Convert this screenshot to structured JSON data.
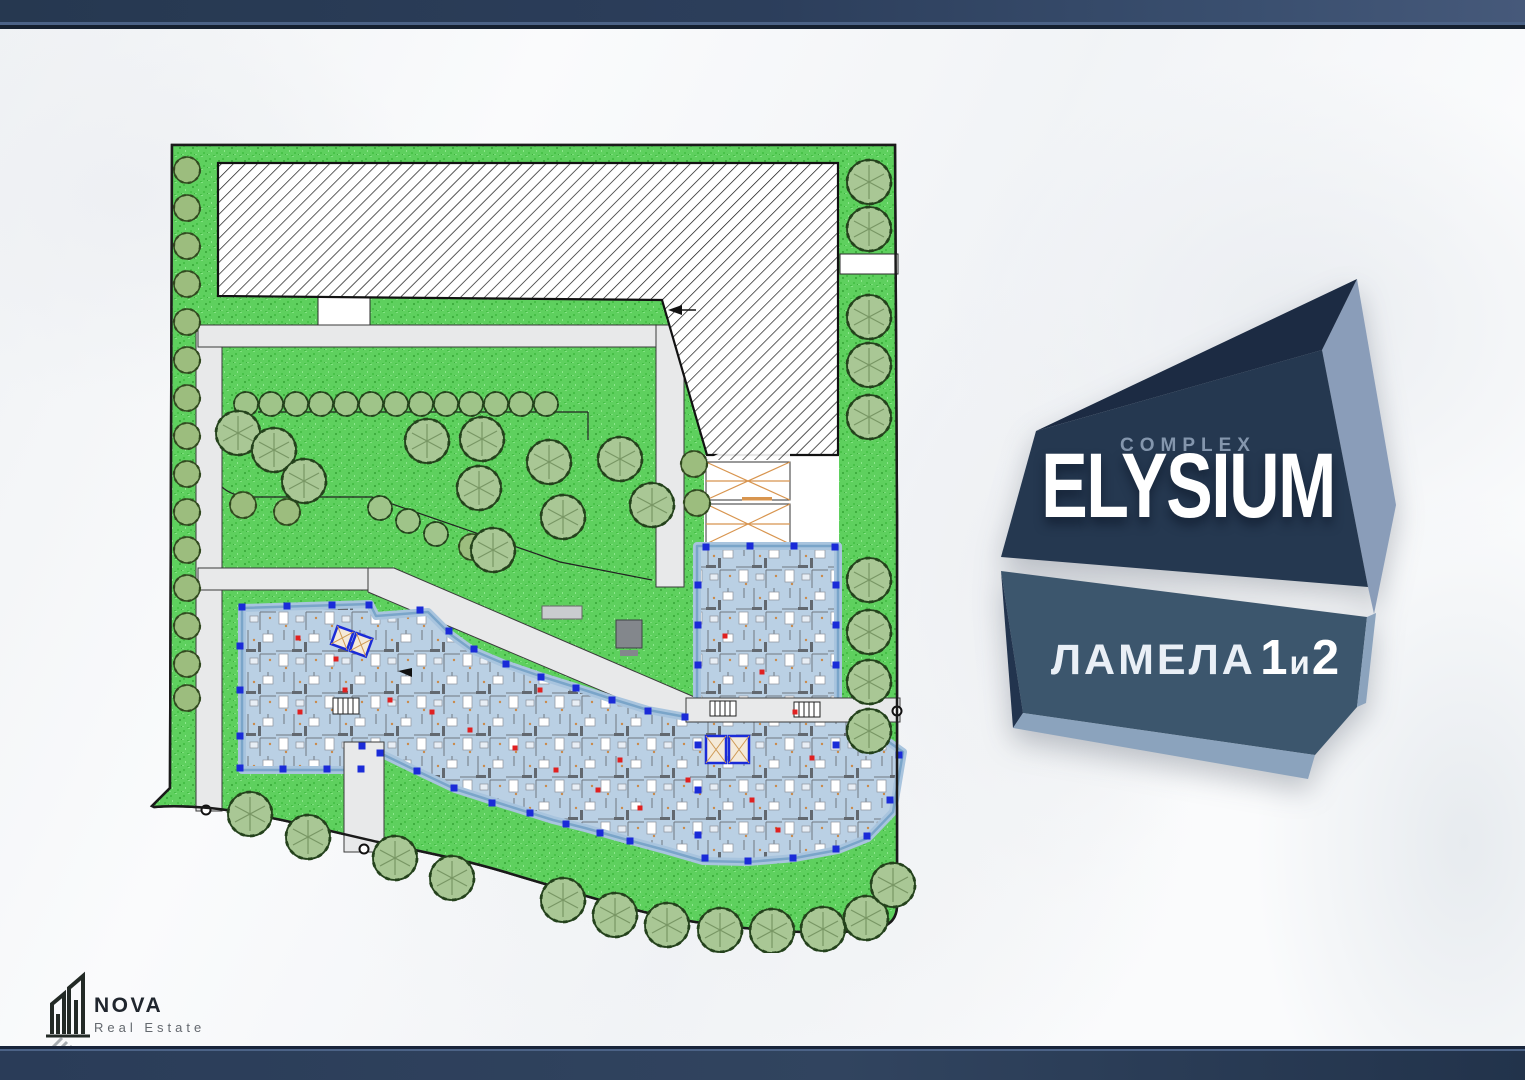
{
  "badge": {
    "kicker": "COMPLEX",
    "name": "ELYSIUM",
    "label": "ЛАМЕЛА",
    "unit_first": "1",
    "conjunction": "и",
    "unit_second": "2"
  },
  "logo": {
    "brand": "NOVA",
    "tagline": "Real Estate"
  },
  "colors": {
    "bar_navy": "#2c3e5b",
    "badge_main": "#253850",
    "badge_facet_dark": "#1c2b43",
    "badge_facet_light": "#8a9db9",
    "badge_kicker_text": "#8496ad",
    "lamela_main": "#3c566d",
    "lamela_facet_dark": "#22344e",
    "lamela_facet_light": "#8ba3bd",
    "plan_paper": "#ffffff",
    "grass": "#5ed05e",
    "path_grey": "#e8e9ea",
    "apartment_fill": "#bad0e4",
    "apartment_outline": "#7aa5c9",
    "column_marker_blue": "#1a2bd8",
    "unit_marker_red": "#e02020",
    "ramp_orange": "#d8954f",
    "tree_green": "#a9c795",
    "bush_green": "#9cbd7e"
  }
}
